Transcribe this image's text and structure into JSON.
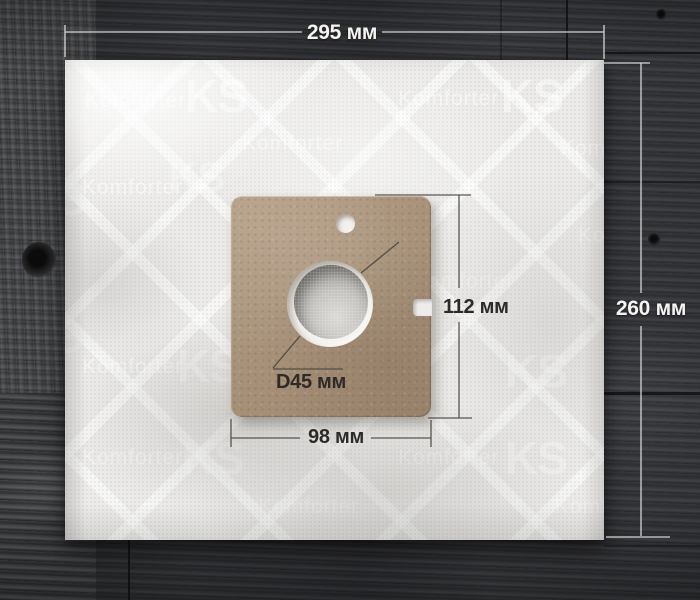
{
  "photo": {
    "description": "Vacuum cleaner dust bag with cardboard mounting plate, photographed on dark wood floor"
  },
  "watermark": {
    "brand": "Komforter",
    "initials": "KS",
    "placements": [
      {
        "t": "brand",
        "x": 20,
        "y": 30,
        "s": 21,
        "o": 0.55
      },
      {
        "t": "initials",
        "x": 120,
        "y": 13,
        "s": 46,
        "o": 0.5
      },
      {
        "t": "brand",
        "x": 333,
        "y": 28,
        "s": 21,
        "o": 0.5
      },
      {
        "t": "initials",
        "x": 436,
        "y": 13,
        "s": 46,
        "o": 0.45
      },
      {
        "t": "brand",
        "x": 177,
        "y": 73,
        "s": 21,
        "o": 0.45
      },
      {
        "t": "initials",
        "x": 103,
        "y": 96,
        "s": 42,
        "o": 0.3
      },
      {
        "t": "brand",
        "x": 495,
        "y": 78,
        "s": 21,
        "o": 0.4
      },
      {
        "t": "brand",
        "x": 17,
        "y": 117,
        "s": 21,
        "o": 0.5
      },
      {
        "t": "initials",
        "x": -42,
        "y": 116,
        "s": 46,
        "o": 0.32
      },
      {
        "t": "brand",
        "x": 513,
        "y": 165,
        "s": 21,
        "o": 0.38
      },
      {
        "t": "brand",
        "x": 175,
        "y": 162,
        "s": 21,
        "o": 0.3
      },
      {
        "t": "brand",
        "x": 348,
        "y": 211,
        "s": 21,
        "o": 0.32
      },
      {
        "t": "initials",
        "x": -45,
        "y": 253,
        "s": 46,
        "o": 0.25
      },
      {
        "t": "brand",
        "x": 17,
        "y": 296,
        "s": 21,
        "o": 0.45
      },
      {
        "t": "initials",
        "x": 112,
        "y": 283,
        "s": 46,
        "o": 0.34
      },
      {
        "t": "initials",
        "x": 440,
        "y": 288,
        "s": 46,
        "o": 0.38
      },
      {
        "t": "brand",
        "x": 17,
        "y": 387,
        "s": 21,
        "o": 0.42
      },
      {
        "t": "initials",
        "x": 117,
        "y": 375,
        "s": 46,
        "o": 0.32
      },
      {
        "t": "brand",
        "x": 333,
        "y": 387,
        "s": 21,
        "o": 0.4
      },
      {
        "t": "initials",
        "x": 440,
        "y": 375,
        "s": 46,
        "o": 0.36
      },
      {
        "t": "brand",
        "x": 193,
        "y": 436,
        "s": 21,
        "o": 0.3
      },
      {
        "t": "brand",
        "x": 490,
        "y": 436,
        "s": 21,
        "o": 0.33
      }
    ]
  },
  "dimensions": {
    "outer_width": {
      "label": "295 мм"
    },
    "outer_height": {
      "label": "260 мм"
    },
    "plate_height": {
      "label": "112 мм"
    },
    "plate_width": {
      "label": "98 мм"
    },
    "hole_diameter": {
      "label": "D45 мм"
    }
  },
  "colors": {
    "bag": "#ecebe9",
    "plate": "#a8927a",
    "wood_dark": "#35363a",
    "wood_light": "#4e4f52",
    "annotation_dark": "#2d2a27",
    "annotation_light": "#f5f4f2"
  }
}
